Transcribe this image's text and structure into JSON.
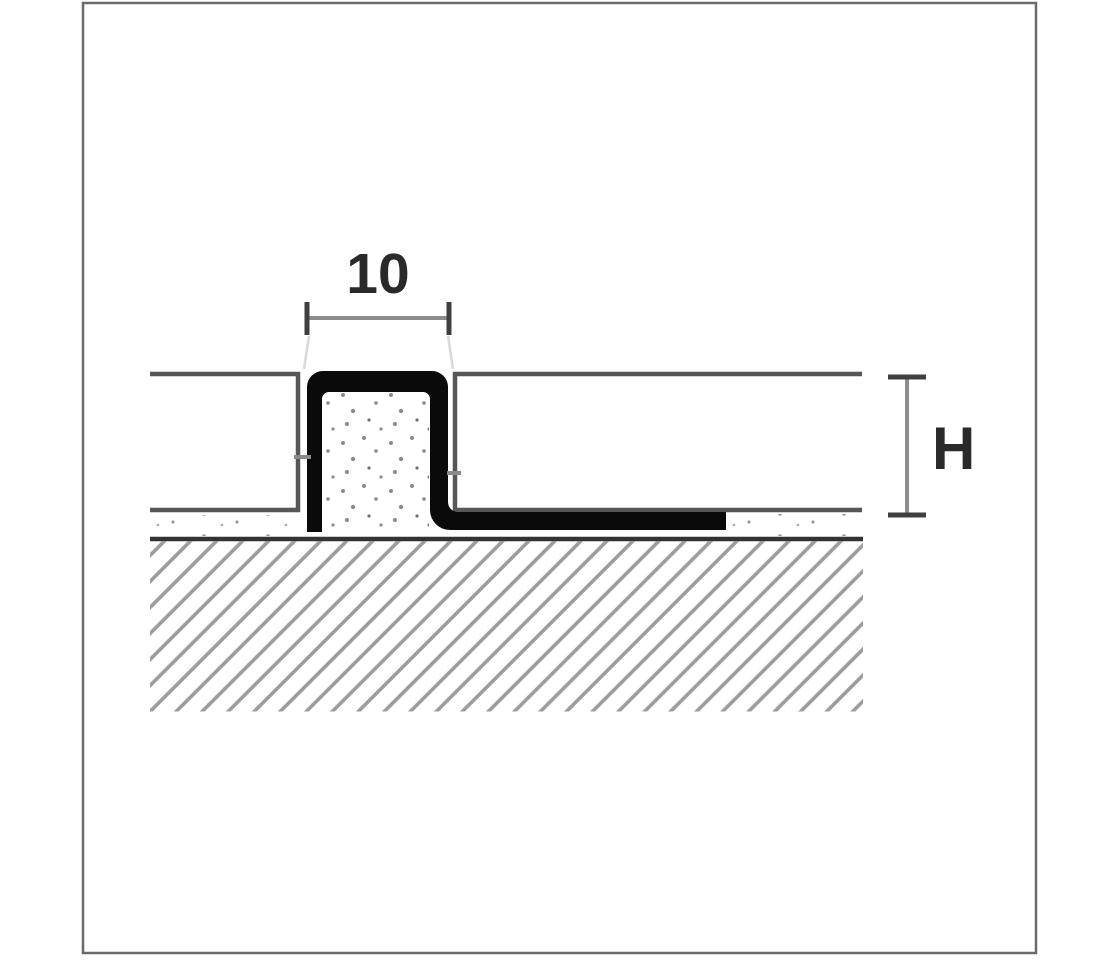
{
  "diagram": {
    "type": "technical-cross-section",
    "subject": "tile movement joint profile",
    "labels": {
      "joint_width": "10",
      "profile_height": "H"
    },
    "colors": {
      "background": "#ffffff",
      "canvas_border": "#6a6a6a",
      "profile_black": "#0a0a0a",
      "tile_line": "#575757",
      "substrate_line": "#333333",
      "hatch_line": "#9c9c9c",
      "dimension_line": "#8c8c8c",
      "dimension_tick": "#3f3f3f",
      "stipple_dot": "#8a8a8a",
      "label_text": "#2a2a2a"
    }
  }
}
